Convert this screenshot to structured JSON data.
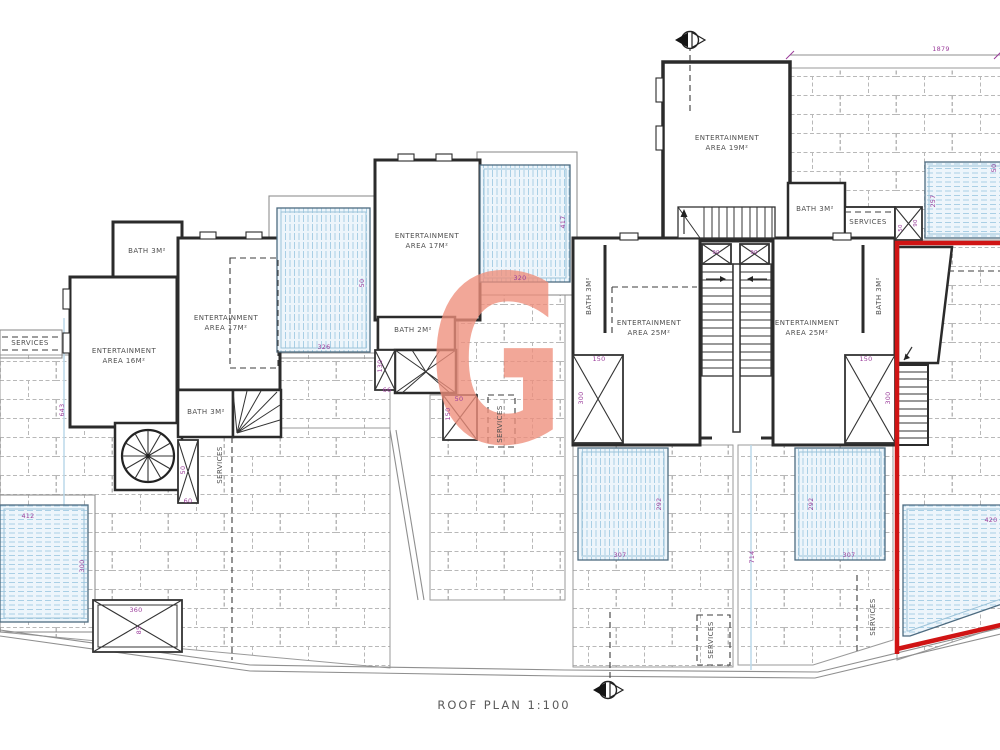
{
  "plan": {
    "title": "ROOF PLAN 1:100",
    "watermark_letter": "G"
  },
  "rooms": {
    "unit19": "ENTERTAINMENT\nAREA 19M²",
    "unit16": "ENTERTAINMENT\nAREA 16M²",
    "unit17a": "ENTERTAINMENT\nAREA 17M²",
    "unit17b": "ENTERTAINMENT\nAREA 17M²",
    "unit25l": "ENTERTAINMENT\nAREA 25M²",
    "unit25r": "ENTERTAINMENT\nAREA 25M²",
    "bath2": "BATH 2M²",
    "bath3": "BATH 3M²",
    "services": "SERVICES"
  },
  "dims": {
    "d1879": "1879",
    "d257": "257",
    "d50": "50",
    "d326": "326",
    "d417": "417",
    "d320": "320",
    "d150": "150",
    "d300": "300",
    "d307": "307",
    "d292": "292",
    "d714": "714",
    "d412": "412",
    "d360": "360",
    "d85": "85",
    "d60": "60",
    "d130": "130",
    "d66": "66",
    "d643": "643",
    "d420": "420",
    "d90": "90"
  },
  "colors": {
    "wall": "#2b2b2b",
    "brick_line": "#b8b8b8",
    "pool_fill": "#edf5fb",
    "pool_hatch": "#a9cfe5",
    "dimension_text": "#9b3d9b",
    "highlight_red": "#d01414",
    "watermark": "#ef8f7c"
  },
  "markers": {
    "top": "section-marker",
    "bottom": "section-marker"
  }
}
